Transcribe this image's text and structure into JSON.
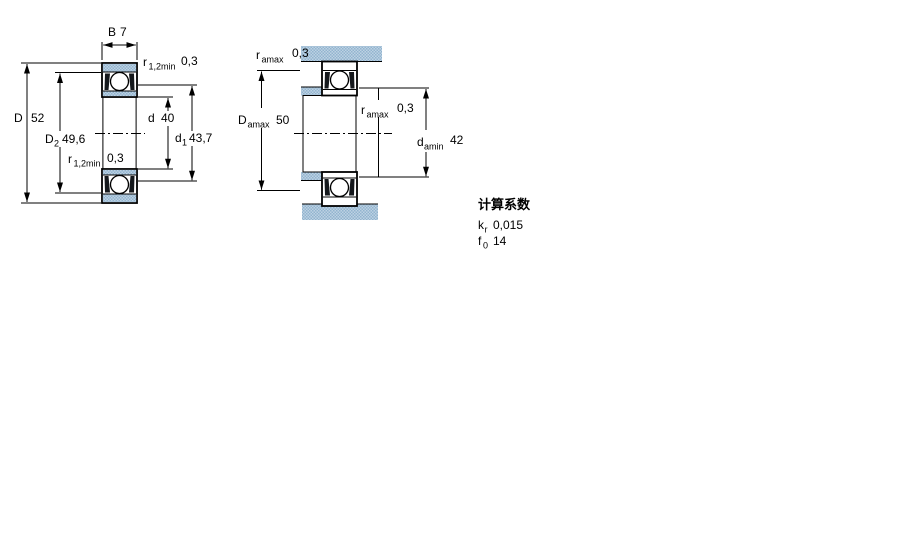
{
  "drawing": {
    "left_view": {
      "B": {
        "sym": "B",
        "sub": "",
        "val": "7"
      },
      "r12_top": {
        "sym": "r",
        "sub": "1,2min",
        "val": "0,3"
      },
      "D": {
        "sym": "D",
        "sub": "",
        "val": "52"
      },
      "D2": {
        "sym": "D",
        "sub": "2",
        "val": "49,6"
      },
      "d": {
        "sym": "d",
        "sub": "",
        "val": "40"
      },
      "d1": {
        "sym": "d",
        "sub": "1",
        "val": "43,7"
      },
      "r12_bottom": {
        "sym": "r",
        "sub": "1,2min",
        "val": "0,3"
      }
    },
    "right_view": {
      "ra_top": {
        "sym": "r",
        "sub": "amax",
        "val": "0,3"
      },
      "Damax": {
        "sym": "D",
        "sub": "amax",
        "val": "50"
      },
      "ra_mid": {
        "sym": "r",
        "sub": "amax",
        "val": "0,3"
      },
      "damin": {
        "sym": "d",
        "sub": "amin",
        "val": "42"
      }
    },
    "calc_factors": {
      "title": "计算系数",
      "kr": {
        "sym": "k",
        "sub": "r",
        "val": "0,015"
      },
      "f0": {
        "sym": "f",
        "sub": "0",
        "val": "14"
      }
    },
    "colors": {
      "line": "#000000",
      "shading_light": "#bdd2e3",
      "shading_dark": "#92b4cf"
    }
  }
}
